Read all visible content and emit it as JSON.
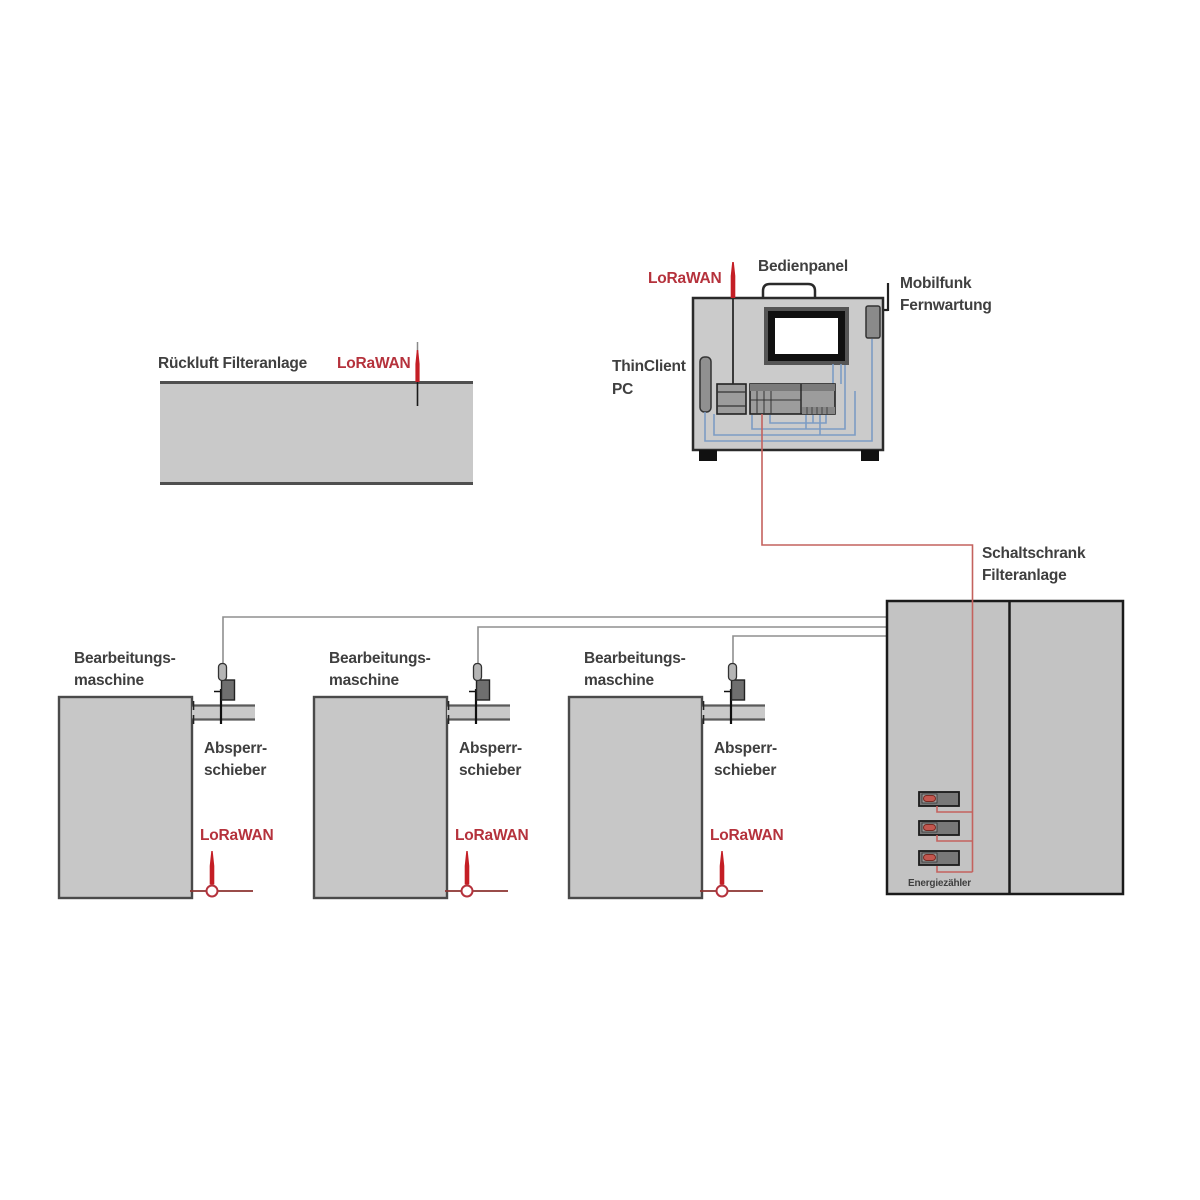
{
  "diagram": {
    "return_air_unit": {
      "label": "Rückluft Filteranlage",
      "antenna_label": "LoRaWAN"
    },
    "control_unit": {
      "lorawan_label": "LoRaWAN",
      "panel_label": "Bedienpanel",
      "mobile_label_line1": "Mobilfunk",
      "mobile_label_line2": "Fernwartung",
      "pc_label_line1": "ThinClient",
      "pc_label_line2": "PC"
    },
    "cabinet": {
      "label_line1": "Schaltschrank",
      "label_line2": "Filteranlage",
      "meter_label": "Energiezähler"
    },
    "machines": [
      {
        "name_line1": "Bearbeitungs-",
        "name_line2": "maschine",
        "valve_line1": "Absperr-",
        "valve_line2": "schieber",
        "antenna_label": "LoRaWAN"
      },
      {
        "name_line1": "Bearbeitungs-",
        "name_line2": "maschine",
        "valve_line1": "Absperr-",
        "valve_line2": "schieber",
        "antenna_label": "LoRaWAN"
      },
      {
        "name_line1": "Bearbeitungs-",
        "name_line2": "maschine",
        "valve_line1": "Absperr-",
        "valve_line2": "schieber",
        "antenna_label": "LoRaWAN"
      }
    ],
    "colors": {
      "accent_red_text": "#b5323c",
      "antenna_red": "#c41e25",
      "wire_red": "#c4625e",
      "wire_blue": "#7d9cc4",
      "wire_gray": "#8f8f8f",
      "body_gray": "#c7c7c7"
    }
  }
}
